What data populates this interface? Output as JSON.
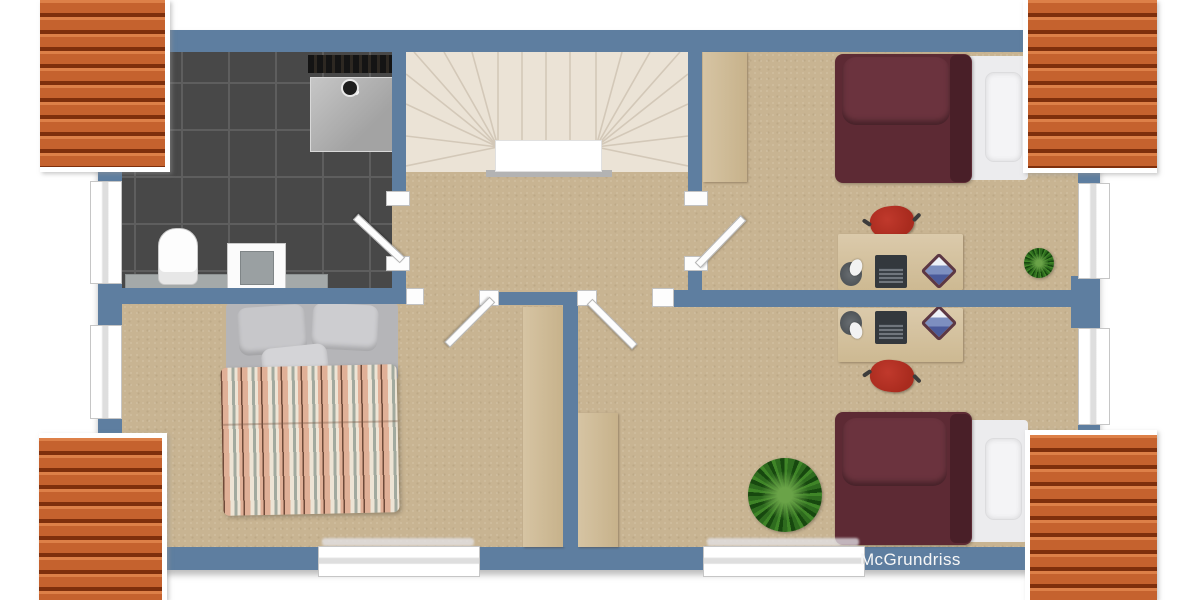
{
  "watermark": {
    "label": "McGrundriss"
  },
  "palette": {
    "wall": "#5e7ea0",
    "floor": "#c8b492",
    "bathroomTile": "#484848",
    "bathroomGrout": "#5e5e5e",
    "roofTile": "#c8662f",
    "roofDark": "#7e2f0c",
    "wood": "#d6c4a3",
    "stair": "#ebe3d6",
    "bedMaroon": "#5d2a34",
    "bedWhite": "#ececee",
    "chairRed": "#a92b1e",
    "plantGreen": "#2e6b1e",
    "windowWhite": "#ffffff",
    "doorWhite": "#fdfdfd",
    "watermarkText": "#f7f7f7"
  },
  "floorplan": {
    "type": "top-down 3D rendered upper-floor plan",
    "rooms": [
      "bathroom",
      "stair-hall",
      "bedroom-bottom-left",
      "room-top-right",
      "room-bottom-right"
    ],
    "furniture": [
      "shower",
      "toilet",
      "sink",
      "double-bed-striped",
      "single-bed-maroon",
      "single-bed-maroon",
      "desk-with-laptop",
      "desk-with-laptop",
      "office-chair-red",
      "office-chair-red",
      "wardrobe",
      "wardrobe",
      "wardrobe",
      "potted-plant-small",
      "potted-plant-large"
    ],
    "window_count": 6,
    "door_count": 4,
    "roof_sections": 4
  }
}
